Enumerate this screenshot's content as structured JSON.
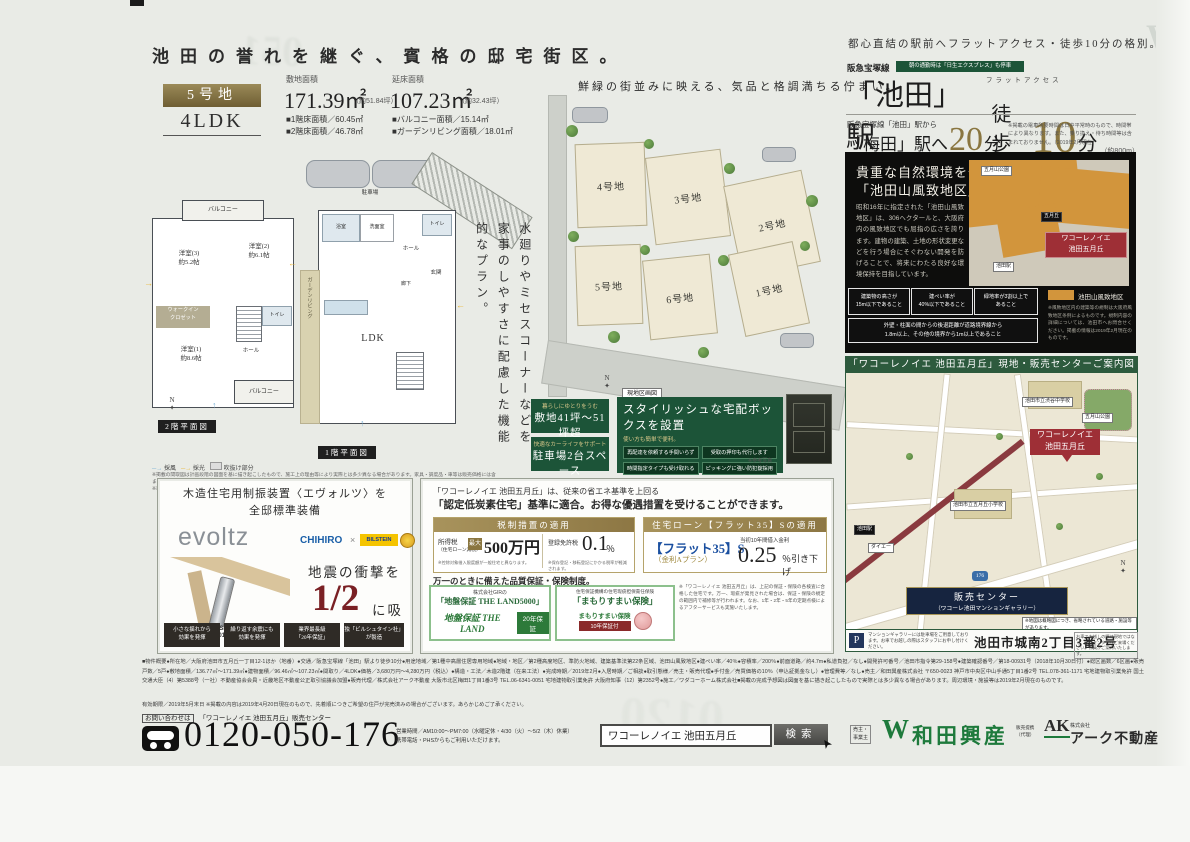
{
  "header": {
    "title": "池田の誉れを継ぐ、賓格の邸宅街区。",
    "access_lead": "都心直結の駅前へフラットアクセス・徒歩10分の格別。"
  },
  "lot": {
    "badge": "5号地",
    "layout": "4LDK",
    "site_area_label": "敷地面積",
    "site_area_value": "171.39㎡",
    "site_area_note": "（約51.84坪）",
    "floor_area_label": "延床面積",
    "floor_area_value": "107.23㎡",
    "floor_area_note": "（約32.43坪）",
    "detail_1": "■1階床面積／60.45㎡",
    "detail_2": "■2階床面積／46.78㎡",
    "detail_3": "■バルコニー面積／15.14㎡",
    "detail_4": "■ガーデンリビング面積／18.01㎡"
  },
  "plans": {
    "copy": "水廻りやミセスコーナーなどを家事のしやすさに配慮した機能的なプラン。",
    "label_2f": "2階平面図",
    "label_1f": "1階平面図",
    "rooms_2f": {
      "balcony1": "バルコニー",
      "room2": "洋室(2)\n約6.1帖",
      "room3": "洋室(3)\n約5.2帖",
      "wic": "ウォークイン\nクロゼット",
      "room1": "洋室(1)\n約8.6帖",
      "balcony2": "バルコニー",
      "toilet": "トイレ",
      "hall": "ホール"
    },
    "rooms_1f": {
      "parking": "駐車場",
      "entrance": "玄関",
      "hall": "ホール",
      "corridor": "廊下",
      "ldk": "LDK",
      "bath": "浴室",
      "wash": "洗面室",
      "toilet": "トイレ",
      "garden": "ガーデンリビング"
    },
    "legend_wind": "採風",
    "legend_light": "採光",
    "legend_box": "吹抜け部分",
    "note": "※掲載の間取図は計画段階の図面を基に描き起こしたもので、施工上の理由等により実際とは多少異なる場合があります。家具・調度品・車等は販売価格には含まれません。\n※車庫・バルコニー・ガーデンリビング面積は延床面積には含まれません。あらかじめご了承ください。",
    "compass_n": "N"
  },
  "siteplan": {
    "caption": "鮮緑の街並みに映える、気品と格調満ちる佇まい。",
    "lot1": "1号地",
    "lot2": "2号地",
    "lot3": "3号地",
    "lot4": "4号地",
    "lot5": "5号地",
    "lot6": "6号地",
    "map_label": "現地区画図",
    "compass_n": "N"
  },
  "features": {
    "banner1_top": "暮らしにゆとりをうむ",
    "banner1_main": "敷地41坪〜51坪超",
    "banner2_top": "快適なカーライフをサポート",
    "banner2_main": "駐車場2台スペース",
    "delivery_title": "スタイリッシュな宅配ボックスを設置",
    "delivery_sub": "使い方も簡単で便利。",
    "point1": "再配達を依頼する手間いらず",
    "point2": "受取の押印も代行します",
    "point3": "時間指定タイプも受け取れる",
    "point4": "ピッキングに強い防犯錠採用",
    "photo_note": "※参考写真"
  },
  "access": {
    "line": "阪急宝塚線",
    "line_badge": "朝の通勤時は「日生エクスプレス」も停車",
    "flat_ruby": "フラットアクセス",
    "station": "「池田」駅",
    "walk": "徒歩",
    "walk_min": "10",
    "walk_unit": "分",
    "walk_note": "（約800m）",
    "umeda_lead": "阪急宝塚線「池田」駅から",
    "umeda_station": "「梅田」駅へ",
    "umeda_min": "20",
    "umeda_unit": "分",
    "umeda_note": "※掲載の電車所要時間は日中平常時のもので、時間帯により異なります。また、乗り換え・待ち時間等は含まれておりません。（2019年2月現在）"
  },
  "fuchi": {
    "title1": "貴重な自然環境を守る",
    "title2": "「池田山風致地区」。",
    "body": "昭和16年に指定された「池田山風致地区」は、306ヘクタールと、大阪府内の風致地区でも屈指の広さを誇ります。建物の建築、土地の形状変更などを行う場合にそぐわない開発を防げることで、将来にわたる良好な環境保持を目指しています。",
    "rule1": "建築物の高さが\n15m以下であること",
    "rule2": "建ぺい率が\n40%以下であること",
    "rule3": "緑地率が3割以上で\nあること",
    "rule_wide": "外壁・柱面の間からの後退距離が道路境界線から\n1.8m以上、その他の境界から1m以上であること",
    "marker": "ワコーレノイエ\n池田五月丘",
    "legend": "池田山風致地区",
    "legend_note": "※風致地区内の建築等の規制は大阪府風致地区条例によるものです。規制内容の詳細については、池田市へお問合せください。掲載の情報は2019年2月現在のものです。",
    "chip1": "五月山公園",
    "chip2": "五月丘",
    "chip3": "池田駅"
  },
  "guide": {
    "header": "「ワコーレノイエ 池田五月丘」現地・販売センターご案内図",
    "marker": "ワコーレノイエ\n池田五月丘",
    "sales1": "販売センター",
    "sales2": "（ワコーレ池田マンションギャラリー）",
    "label_park": "五月山公園",
    "label_junior": "池田市立渋谷中学校",
    "label_elem": "池田市立五月丘小学校",
    "label_daiei": "ダイエー",
    "label_station": "池田駅",
    "route": "176",
    "address": "池田市城南2丁目3番2号",
    "p": "P",
    "p_note": "マンションギャラリーには駐車場をご用意しております。お車でお越しの際はスタッフにお申し付けください。",
    "right_note": "お車でお越しの際は現地ではなく、販売センターへご来場ください。係員がご案内いたします。",
    "map_note": "※地図は概略図につき、省略されている道路・施設等があります。",
    "compass_n": "N"
  },
  "evoltz": {
    "title": "木造住宅用制振装置〈エヴォルツ〉を\n全邸標準装備",
    "brand": "evoltz",
    "brand2": "CHIHIRO",
    "brand_x": "×",
    "brand3": "BILSTEIN",
    "award1": "GOOD DESIGN",
    "award2": "AWARD 2018",
    "head_pre": "地震の衝撃を",
    "head_big": "1/2",
    "head_post": "に吸収",
    "point1": "小さな揺れから\n効果を発揮",
    "point2": "繰り返す余震にも\n効果を発揮",
    "point3": "業界最長級\n「20年保証」",
    "point4": "独「ビルシュタイン社」\nが製造"
  },
  "carbon": {
    "lead1": "「ワコーレノイエ 池田五月丘」は、従来の省エネ基準を上回る",
    "lead2": "「認定低炭素住宅」基準に適合。お得な優遇措置を受けることができます。",
    "tax_header": "税制措置の適用",
    "tax1_label": "所得税",
    "tax1_sub": "（住宅ローン減税）",
    "tax1_badge": "最大",
    "tax1_value": "500万円",
    "tax1_note": "※控除対象借入限度額が一般住宅と異なります。",
    "tax2_label": "登録免許税",
    "tax2_value": "0.1",
    "tax2_unit": "％",
    "tax2_note": "※保存登記・移転登記にかかる税率が軽減されます。",
    "flat_header": "住宅ローン【フラット35】Sの適用",
    "flat_name": "【フラット35】S",
    "flat_plan": "（金利Aプラン）",
    "flat_label": "当初10年間借入金利",
    "flat_value": "0.25",
    "flat_suffix": "％引き下げ",
    "hosho_lead": "万一のときに備えた品質保証・保険制度。",
    "jiban_head": "株式会社GIRの",
    "jiban_title": "「地盤保証 THE LAND5000」",
    "jiban_logo": "地盤保証 THE LAND",
    "jiban_badge": "20年保証",
    "mamori_head": "住宅保証機構の住宅瑕疵担保責任保険",
    "mamori_title": "「まもりすまい保険」",
    "mamori_logo": "まもりすまい保険",
    "mamori_badge": "10年保証付",
    "side_note": "※「ワコーレノイエ 池田五月丘」は、上記の保証・保険の各検査に合格した住宅です。万一、瑕疵が発見された場合は、保証・保険の規定の範囲内で補修等が行われます。なお、1年・2年・5年の定期点検によるアフターサービスも実施いたします。"
  },
  "legal": {
    "line1": "■物件概要●所在地／大阪府池田市五月丘一丁目12-1ほか（地番）●交通／阪急宝塚線「池田」駅より徒歩10分●用途地域／第1種中高層住居専用地域●地域・地区／第2種高度地区、準防火地域、建築基準法第22条区域、池田山風致地区●建ぺい率／40％●容積率／200％●前面道路／約4.7m●私道負担／なし●開発許可番号／池田市指令第29-158号●建築確認番号／第18-00931号（2018年10月30日付）●総区画数／6区画●販売戸数／5戸●敷地面積／136.77㎡〜171.39㎡●建物面積／96.46㎡〜107.23㎡●間取り／4LDK●価格／3,680万円〜4,280万円（税込）●構造・工法／木造2階建（在来工法）●完成時期／2019年2月●入居時期／ご相談●取引態様／売主・販売代理●手付金／売買価格の10％（申込証拠金なし）●管理費等／なし●売主／和田興産株式会社 〒650-0023 神戸市中央区中山手通5丁目1番2号 TEL.078-361-1171 宅地建物取引業免許 国土交通大臣（4）第5388号（一社）不動産協会会員・近畿地区不動産公正取引協議会加盟●販売代理／株式会社アーク不動産 大阪市北区梅田1丁目1番3号 TEL.06-6341-0051 宅地建物取引業免許 大阪府知事（12）第2352号●施工／ワダコーホーム株式会社■掲載の完成予想図は図面を基に描き起こしたもので実際とは多少異なる場合があります。周辺環境・施設等は2019年2月現在のものです。",
    "line2": "有効期限／2019年5月末日 ※掲載の内容は2019年4月20日現在のもので、先着順につきご希望の住戸が完売済みの場合がございます。あらかじめご了承ください。"
  },
  "contact": {
    "lead_label": "お問い合わせは",
    "lead_center": "「ワコーレノイエ 池田五月丘」販売センター",
    "phone": "0120-050-176",
    "hours1": "営業時間／AM10:00〜PM7:00（水曜定休・4/30（火）〜5/2（木）休業）",
    "hours2": "携帯電話・PHSからもご利用いただけます。",
    "search_value": "ワコーレノイエ 池田五月丘",
    "search_button": "検索",
    "seller_label": "売主・\n事業主",
    "seller_mark": "W",
    "seller_name": "和田興産",
    "agent_label": "販売提携\n（代理）",
    "agent_mark": "AK",
    "agent_company": "株式会社",
    "agent_name": "アーク不動産"
  }
}
